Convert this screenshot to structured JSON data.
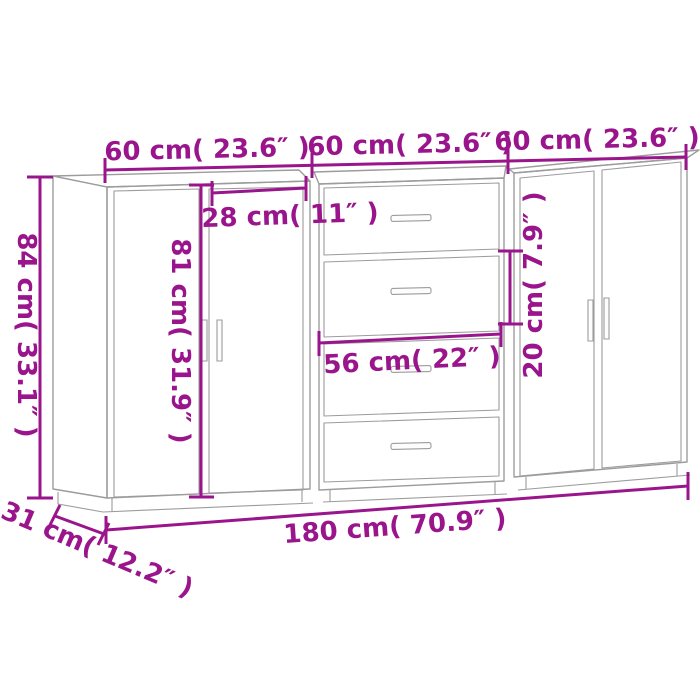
{
  "colors": {
    "dimension_annotation": "#9a158c",
    "furniture_outline": "#9c9c9c",
    "background": "#ffffff"
  },
  "dimensions": {
    "unit_width_1": "60 cm( 23.6″ )",
    "unit_width_2": "60 cm( 23.6″ )",
    "unit_width_3": "60 cm( 23.6″ )",
    "total_height": "84 cm( 33.1″ )",
    "door_height": "81 cm( 31.9″ )",
    "door_width": "28 cm( 11″ )",
    "drawer_width": "56 cm( 22″ )",
    "drawer_height": "20 cm( 7.9″ )",
    "total_width": "180 cm( 70.9″ )",
    "depth": "31 cm( 12.2″ )"
  }
}
